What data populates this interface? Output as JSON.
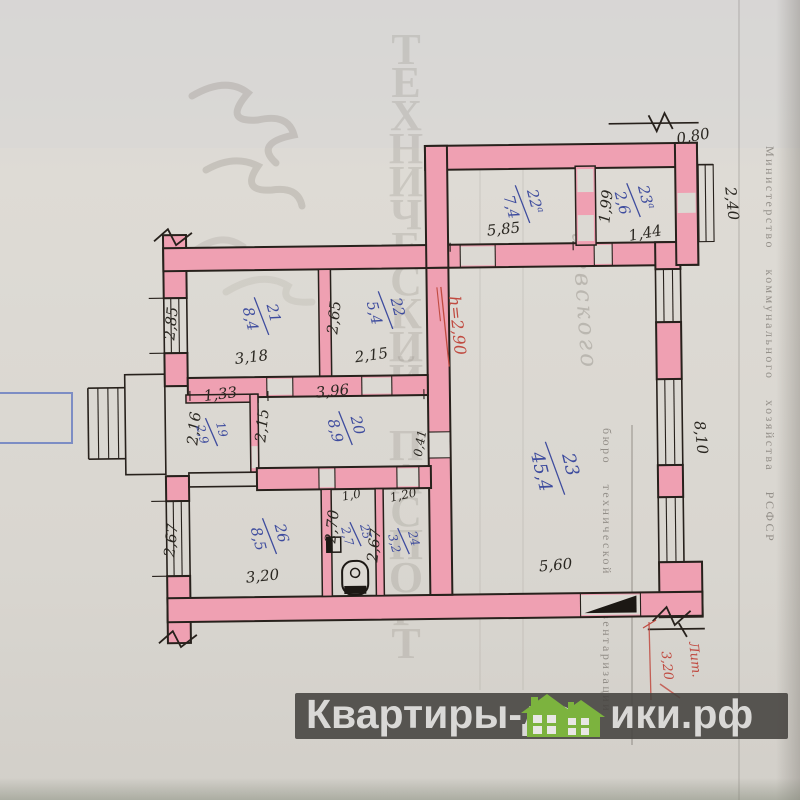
{
  "rooms": {
    "r19": {
      "num": "19",
      "area": "2,9"
    },
    "r20": {
      "num": "20",
      "area": "8,9"
    },
    "r21": {
      "num": "21",
      "area": "8,4"
    },
    "r22": {
      "num": "22",
      "area": "5,4"
    },
    "r22a": {
      "num": "22",
      "sup": "а",
      "area": "7,4"
    },
    "r23": {
      "num": "23",
      "area": "45,4"
    },
    "r23a": {
      "num": "23",
      "sup": "а",
      "area": "2,6"
    },
    "r24": {
      "num": "24",
      "area": "3,2"
    },
    "r25": {
      "num": "25",
      "area": "2,7"
    },
    "r26": {
      "num": "26",
      "area": "8,5"
    }
  },
  "dims": {
    "balcony_width": "0,80",
    "balcony_length": "2,40",
    "top_room_width": "5,85",
    "top_small_width": "1,44",
    "top_small_depth": "1,99",
    "left_upper": "2,85",
    "r21_width": "3,18",
    "r22_left": "2,65",
    "r22_width": "2,15",
    "r19_width": "1,33",
    "r19_depth": "2,16",
    "corridor_left": "2,15",
    "corridor_width": "3,96",
    "wall_thickness": "0,41",
    "left_lower": "2,67",
    "r26_width": "3,20",
    "r25_width": "1,0",
    "r25_depth": "2,70",
    "r24_width": "1,20",
    "r24_depth": "2,67",
    "hall_width": "5,60",
    "hall_depth": "8,10"
  },
  "red_notes": {
    "ceiling_height": "h=2,90",
    "liter": "Лит.",
    "length": "3,20"
  },
  "margin_notes": {
    "ministry": "Министерство коммунального хозяйства РСФСР",
    "bti": "бюро технической инвентаризации"
  },
  "ghost": {
    "title": "ТЕХНИЧЕСКИЙ ПАСПОРТ",
    "cursive": "шевского"
  },
  "footer": {
    "brand_left": "Квартиры-до",
    "brand_right": "ики.рф"
  },
  "colors": {
    "wall_pink": "#efa0b2",
    "ink_blue": "#3e4c9e",
    "ink_red": "#c04a40",
    "brand_green": "#7cb33e",
    "paper": "#dcd9d3"
  }
}
